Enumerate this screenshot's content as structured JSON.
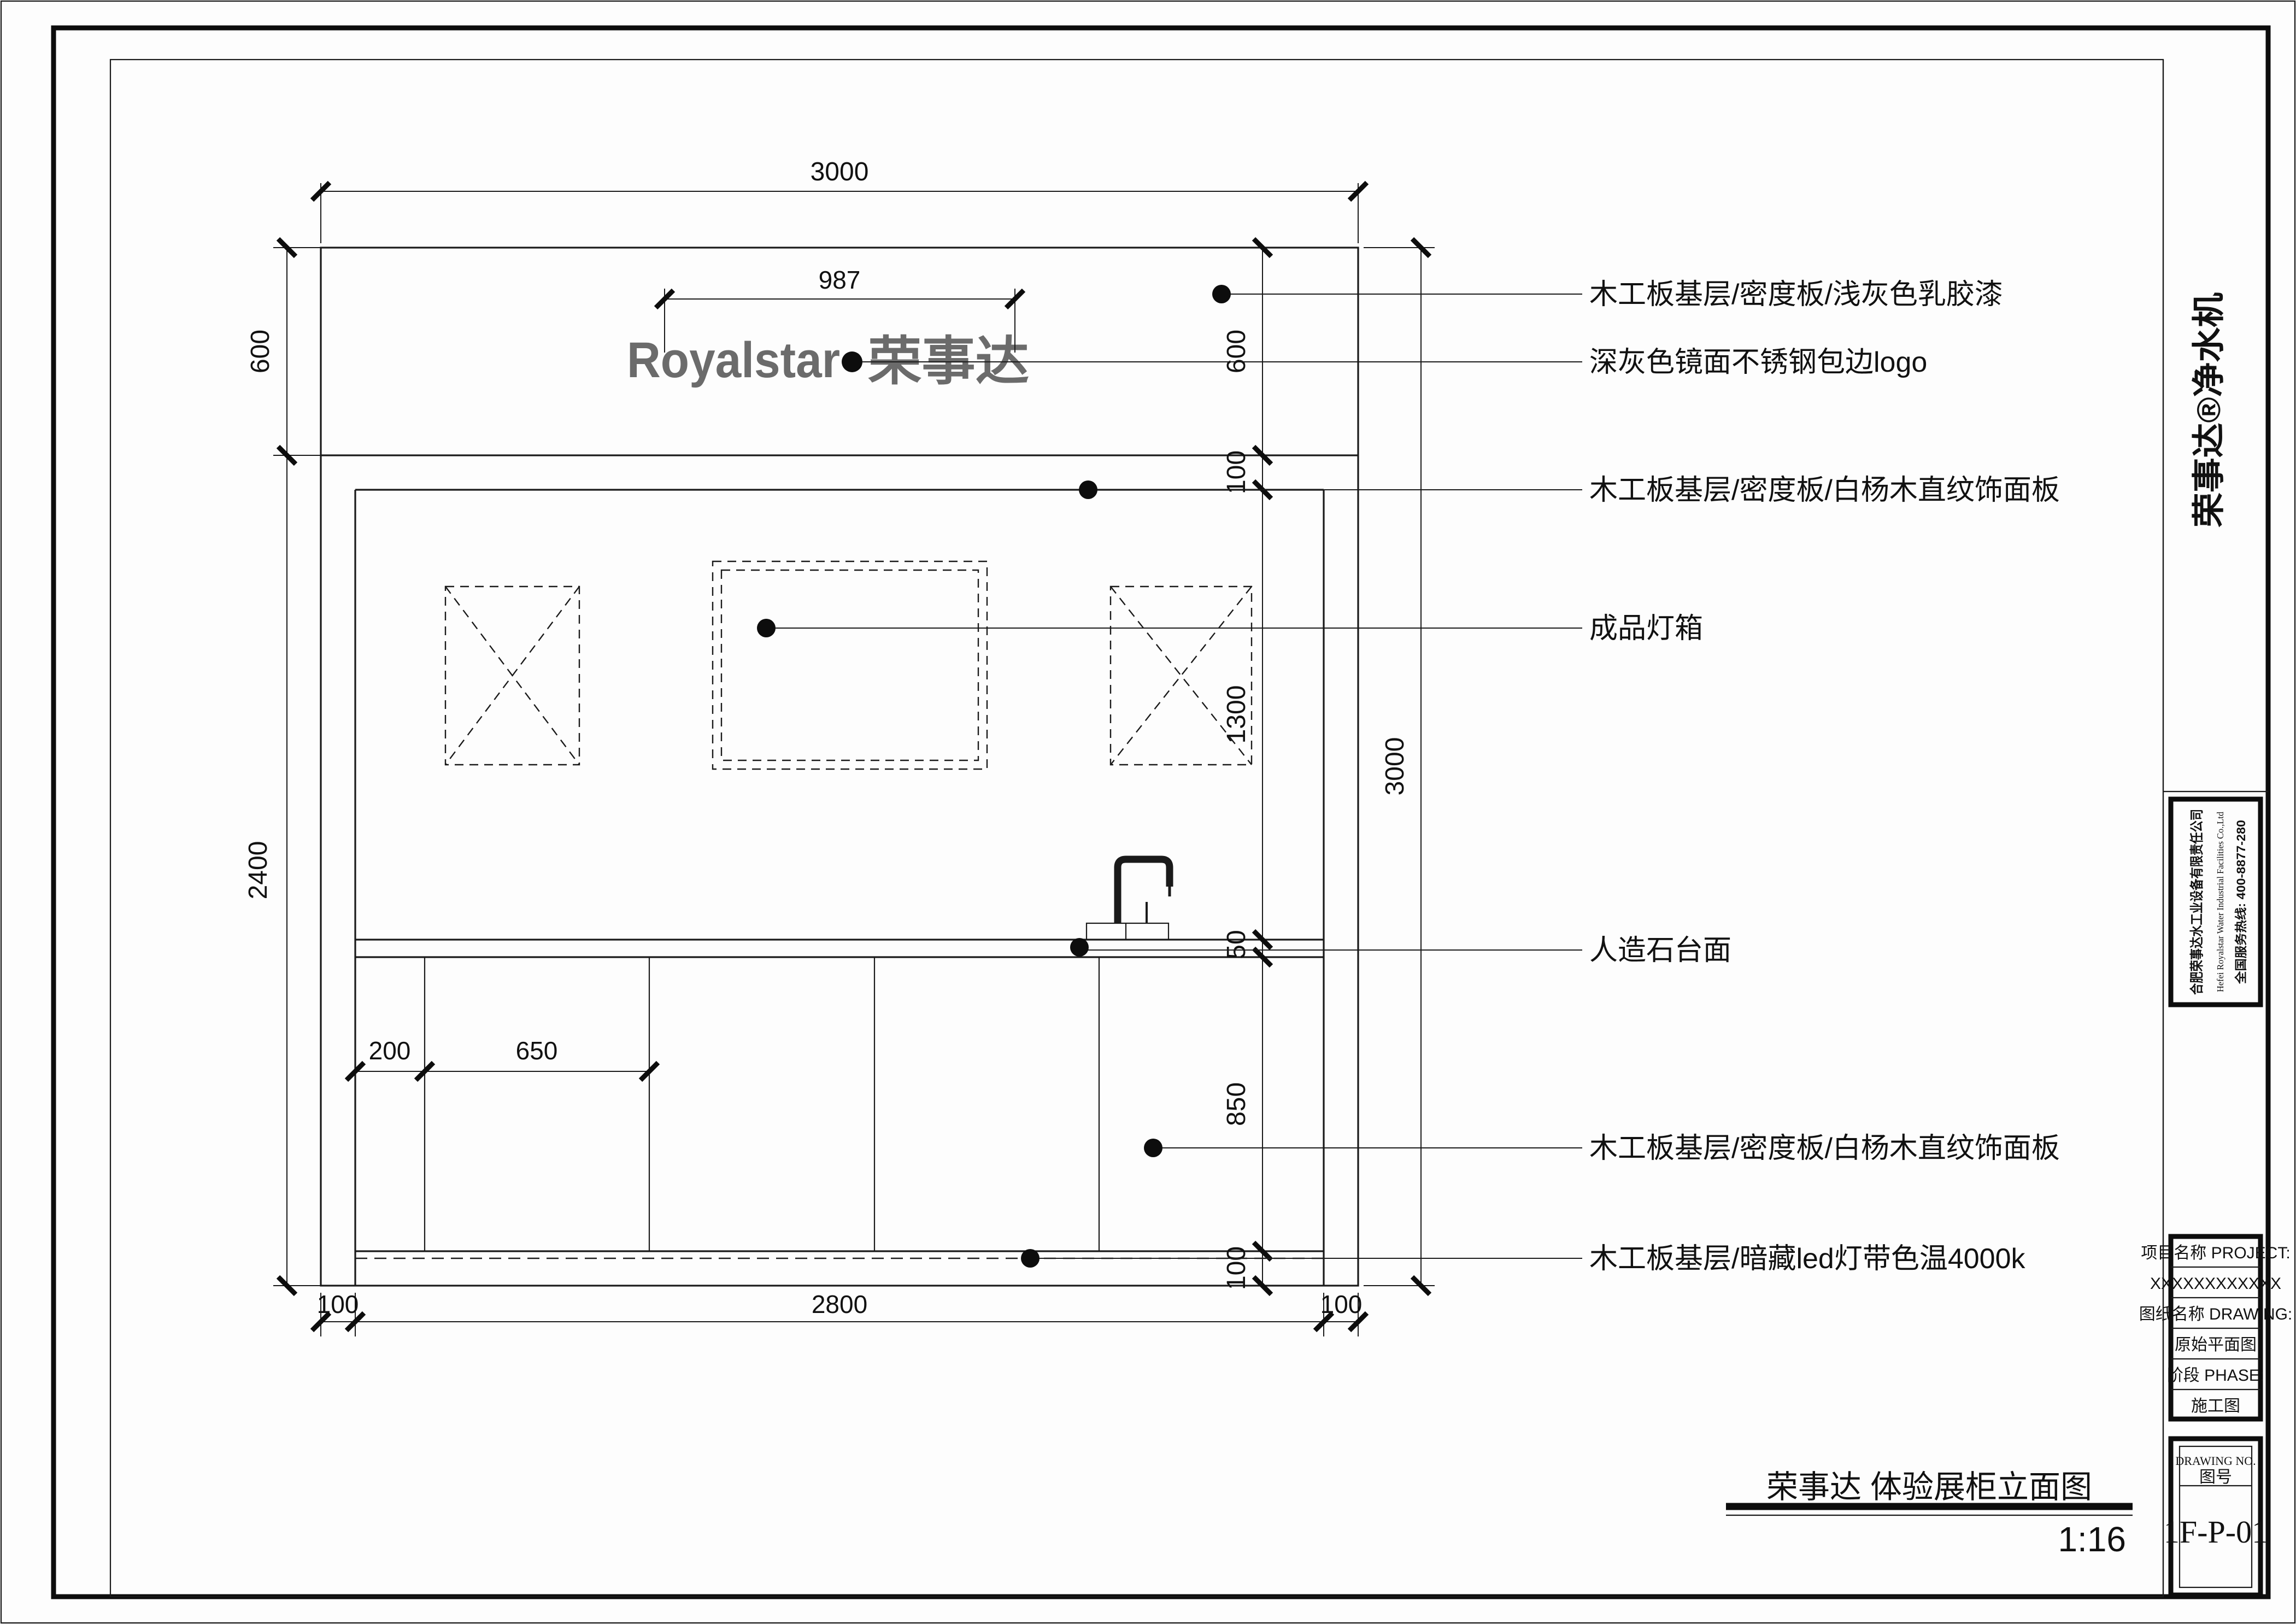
{
  "sheet": {
    "logo": {
      "en": "Royalstar",
      "cn": "荣事达"
    },
    "dims": {
      "overall_width": "3000",
      "overall_height": "3000",
      "logo_width": "987",
      "top_band": "600",
      "body_height": "2400",
      "gap_100": "100",
      "lightbox_zone": "1300",
      "countertop": "50",
      "base_cabinet": "850",
      "toe_kick": "100",
      "bottom_margin_left": "100",
      "bottom_inner_width": "2800",
      "bottom_margin_right": "100",
      "base_small": "200",
      "base_door": "650"
    },
    "annotations": [
      {
        "text": "木工板基层/密度板/浅灰色乳胶漆"
      },
      {
        "text": "深灰色镜面不锈钢包边logo"
      },
      {
        "text": "木工板基层/密度板/白杨木直纹饰面板"
      },
      {
        "text": "成品灯箱"
      },
      {
        "text": "人造石台面"
      },
      {
        "text": "木工板基层/密度板/白杨木直纹饰面板"
      },
      {
        "text": "木工板基层/暗藏led灯带色温4000k"
      }
    ],
    "title": {
      "text": "荣事达 体验展柜立面图",
      "scale": "1:16"
    },
    "sidebar": {
      "brand": "荣事达®净水机",
      "company_cn": "合肥荣事达水工业设备有限责任公司",
      "company_en": "Hefei Royalstar Water Industrial Facilities Co.,Ltd",
      "hotline": "全国服务热线: 400-8877-280",
      "rows": [
        {
          "text": "项目名称 PROJECT:"
        },
        {
          "text": "XXXXXXXXXXXX"
        },
        {
          "text": "图纸名称 DRAWING:"
        },
        {
          "text": "原始平面图"
        },
        {
          "text": "阶段 PHASE:"
        },
        {
          "text": "施工图"
        }
      ],
      "drawing_no": {
        "label_en": "DRAWING NO.",
        "label_cn": "图号",
        "value": "1F-P-01"
      }
    },
    "colors": {
      "line": "#1a1a1a",
      "logo_gray": "#6b6b6b",
      "background": "#fdfdfd"
    }
  }
}
